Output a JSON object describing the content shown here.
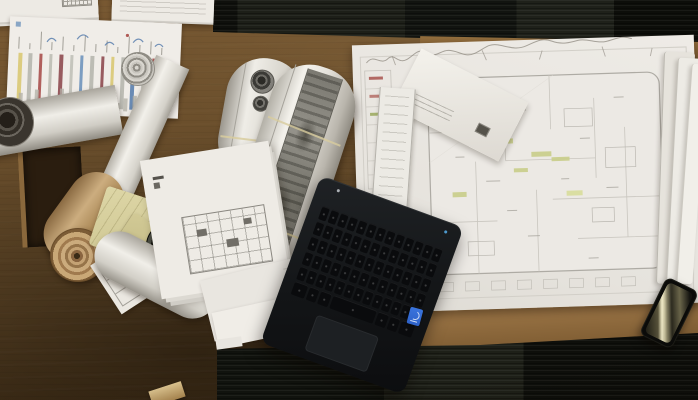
{
  "scene": {
    "description": "Top-down photograph of an architect's wooden desk covered with rolled-up blueprints, architectural floor-plan drawings, a chart printout, kraft paper rolls, an open black laptop with a blue processor sticker, and a smartphone with a glossy screen reflection; dark striped carpet shows along the top edge and the lower-right corner of the frame.",
    "colors": {
      "wood_base": "#5f4626",
      "wood_light": "#7a5a33",
      "wood_dark": "#3f2c14",
      "wood_edge": "#a27b4b",
      "carpet": "#15160f",
      "carpet_panel": "#20221b",
      "paper": "#edeae4",
      "paper_shadow": "#c9c6bf",
      "print_gray": "#8f8c84",
      "kraft": "#c2a173",
      "yellow_paper": "#d7d0a0",
      "laptop_body": "#141619",
      "laptop_key": "#0a0b0d",
      "intel_sticker": "#2e62c9",
      "highlight_green": "#c9ce8a",
      "phone_glare": "#efe9c4"
    },
    "objects": [
      "paper stacks along top-left edge",
      "chart printout with colored vertical stripes",
      "white drawing rolls",
      "roll printed with two circular photo details",
      "long roll with dark gray printed band and rubber bands",
      "kraft paper roll with spiral end",
      "tightly rolled dark blueprint with spiral end",
      "crumpled yellow-green paper",
      "small receipt-like sheet with table",
      "sheet with small floor-plan drawing",
      "large floor-plan blueprint with pencil sketches and green highlights",
      "white envelope with stamp",
      "stacked page edges at right",
      "black laptop with keyboard, trackpad and blue sticker",
      "black smartphone with screen glare",
      "dark cardboard tube box"
    ]
  },
  "chart_paper": {
    "stripe_colors": [
      "#d9c873",
      "#b6b6ae",
      "#a94f4c",
      "#bcbcb4",
      "#8e4a50",
      "#c0c0b8",
      "#6f94bc",
      "#b6b6ae",
      "#8e4a50",
      "#d9c873",
      "#b6b6ae",
      "#5b7fae",
      "#bcbcb4",
      "#a94f4c",
      "#b6b6ae"
    ],
    "mini_bar_heights": [
      14,
      8,
      18,
      6,
      12,
      20,
      9,
      15,
      7,
      17,
      11,
      19,
      8,
      13,
      16,
      6,
      14,
      10
    ]
  },
  "laptop": {
    "keyboard_rows": 5,
    "keyboard_cols": 13,
    "bottom_row_weights": [
      1.4,
      1,
      1,
      4.6,
      1,
      1,
      1.4
    ],
    "sticker_color": "#2e62c9"
  }
}
